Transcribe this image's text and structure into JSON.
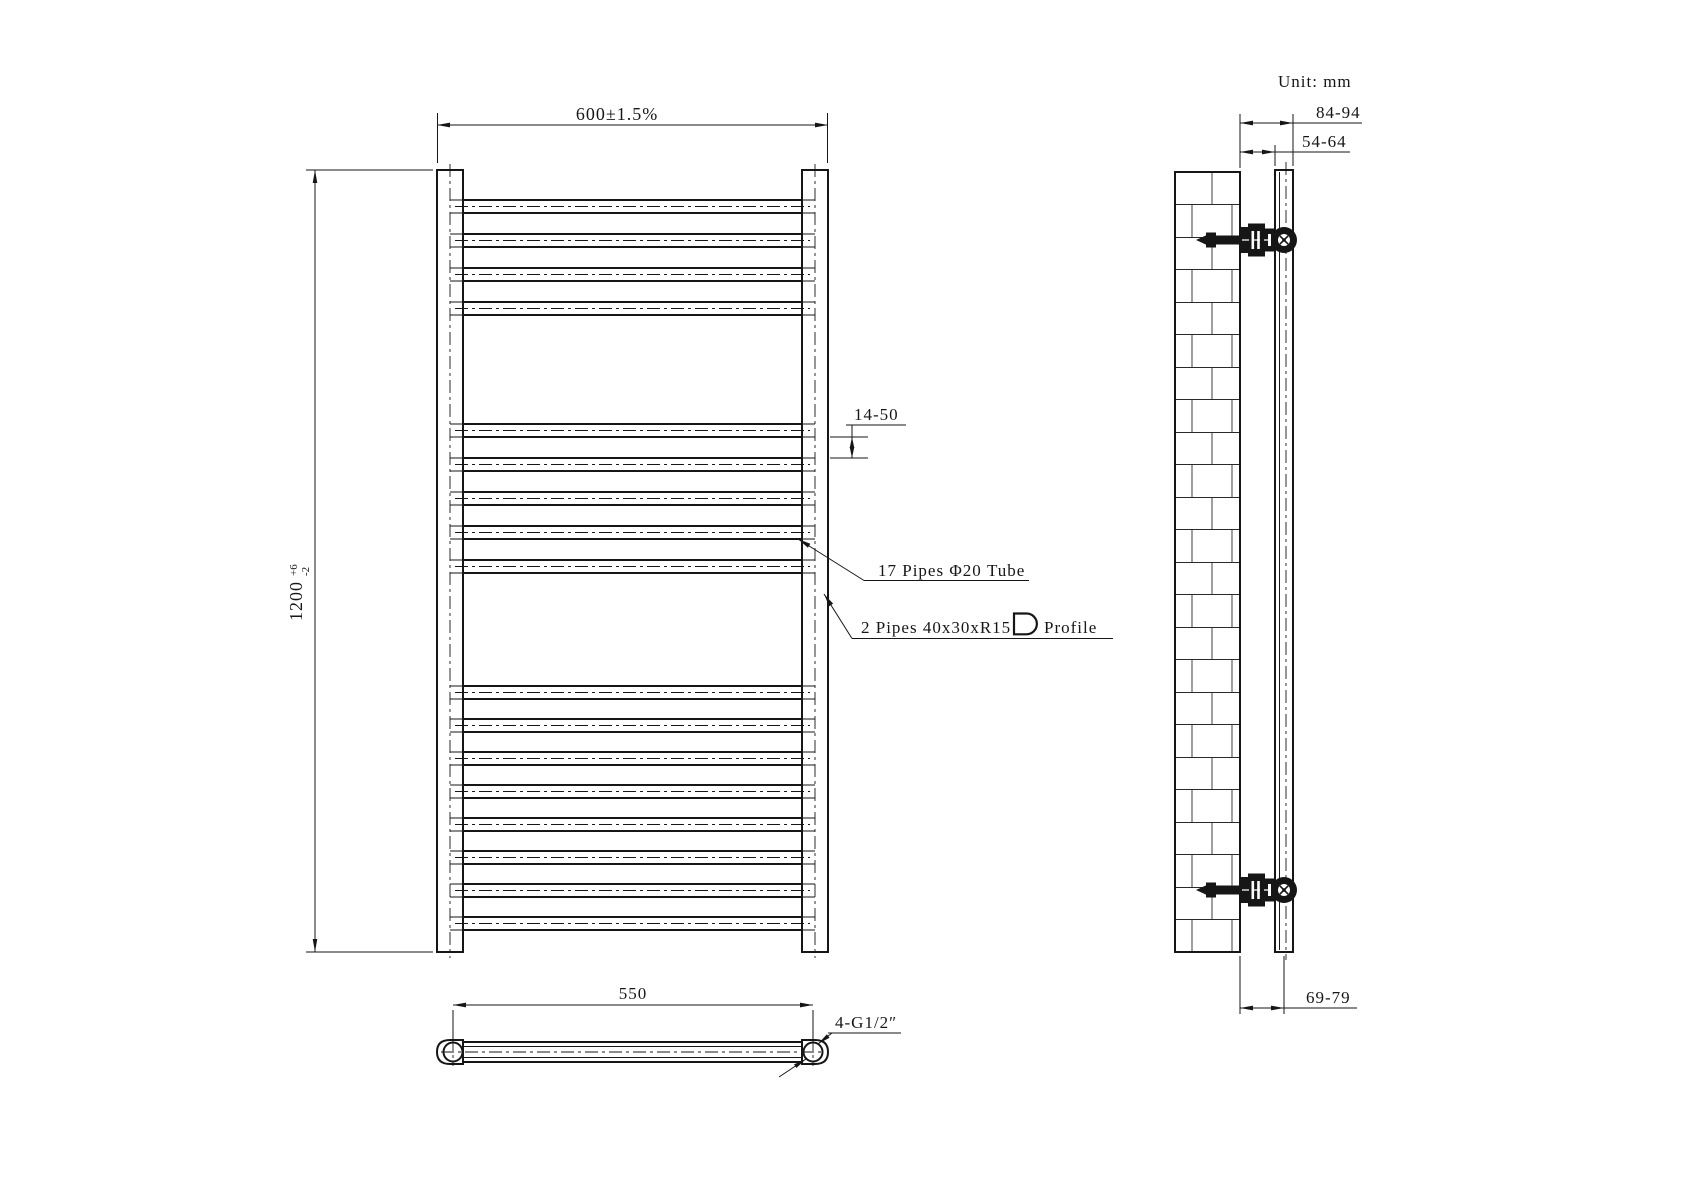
{
  "drawing": {
    "unit_label": "Unit: mm",
    "front_view": {
      "width_dim": "600±1.5%",
      "height_dim_value": "1200",
      "height_tol_plus": "+6",
      "height_tol_minus": "-2",
      "pipe_gap_dim": "14-50",
      "pipes_note": "17 Pipes Φ20 Tube",
      "posts_note": "2 Pipes 40x30xR15",
      "profile_note": "Profile",
      "pipe_count": 17,
      "pipe_height_px": 13,
      "pipe_tops_px": [
        200,
        234,
        268,
        302,
        424,
        458,
        492,
        526,
        560,
        686,
        719,
        752,
        785,
        818,
        851,
        884,
        917
      ]
    },
    "bottom_view": {
      "span_dim": "550",
      "fitting_note": "4-G1/2″"
    },
    "side_view": {
      "outer_depth_dim": "84-94",
      "inner_depth_dim": "54-64",
      "center_depth_dim": "69-79",
      "bracket_centers_y_px": [
        240,
        890
      ]
    },
    "colors": {
      "line": "#161616",
      "background": "#ffffff"
    }
  }
}
